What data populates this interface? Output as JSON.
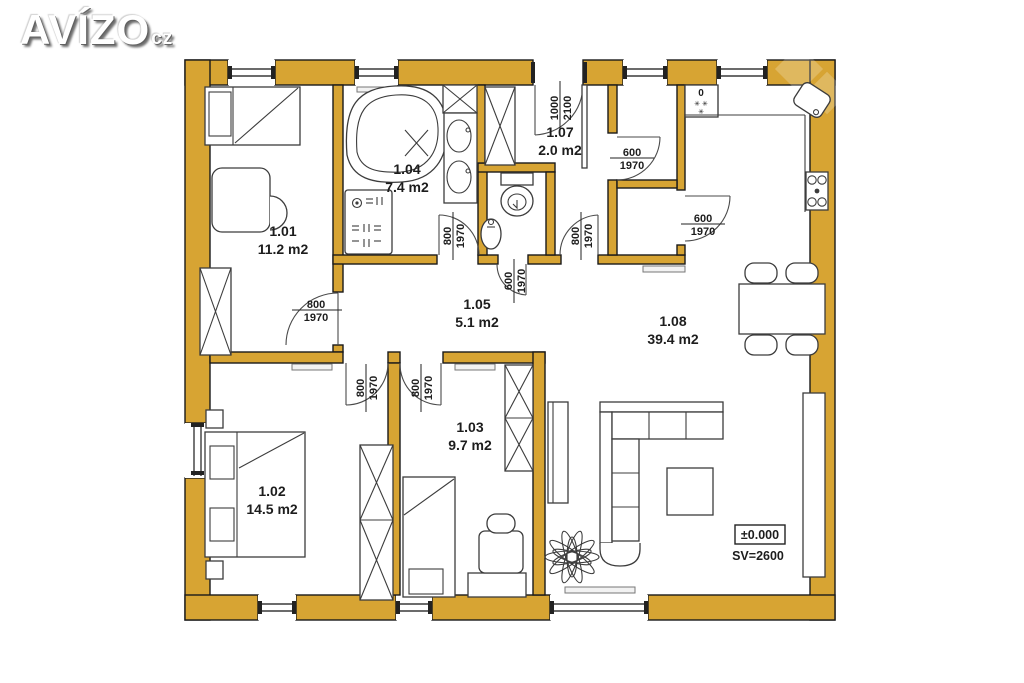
{
  "logo": {
    "main": "AVÍZO",
    "suffix": "cz"
  },
  "rooms": [
    {
      "id": "1.01",
      "area": "11.2 m2"
    },
    {
      "id": "1.02",
      "area": "14.5 m2"
    },
    {
      "id": "1.03",
      "area": "9.7 m2"
    },
    {
      "id": "1.04",
      "area": "7.4 m2"
    },
    {
      "id": "1.05",
      "area": "5.1 m2"
    },
    {
      "id": "1.07",
      "area": "2.0 m2"
    },
    {
      "id": "1.08",
      "area": "39.4 m2"
    }
  ],
  "doors": [
    {
      "w": "800",
      "h": "1970"
    },
    {
      "w": "800",
      "h": "1970"
    },
    {
      "w": "800",
      "h": "1970"
    },
    {
      "w": "800",
      "h": "1970"
    },
    {
      "w": "600",
      "h": "1970"
    },
    {
      "w": "800",
      "h": "1970"
    },
    {
      "w": "1000",
      "h": "2100"
    },
    {
      "w": "600",
      "h": "1970"
    },
    {
      "w": "600",
      "h": "1970"
    }
  ],
  "kitchen": {
    "fridge_zero": "0",
    "fridge_stars_top": "✳ ✳",
    "fridge_stars_bottom": "✳"
  },
  "levels": {
    "elevation": "±0.000",
    "clear_height": "SV=2600"
  }
}
